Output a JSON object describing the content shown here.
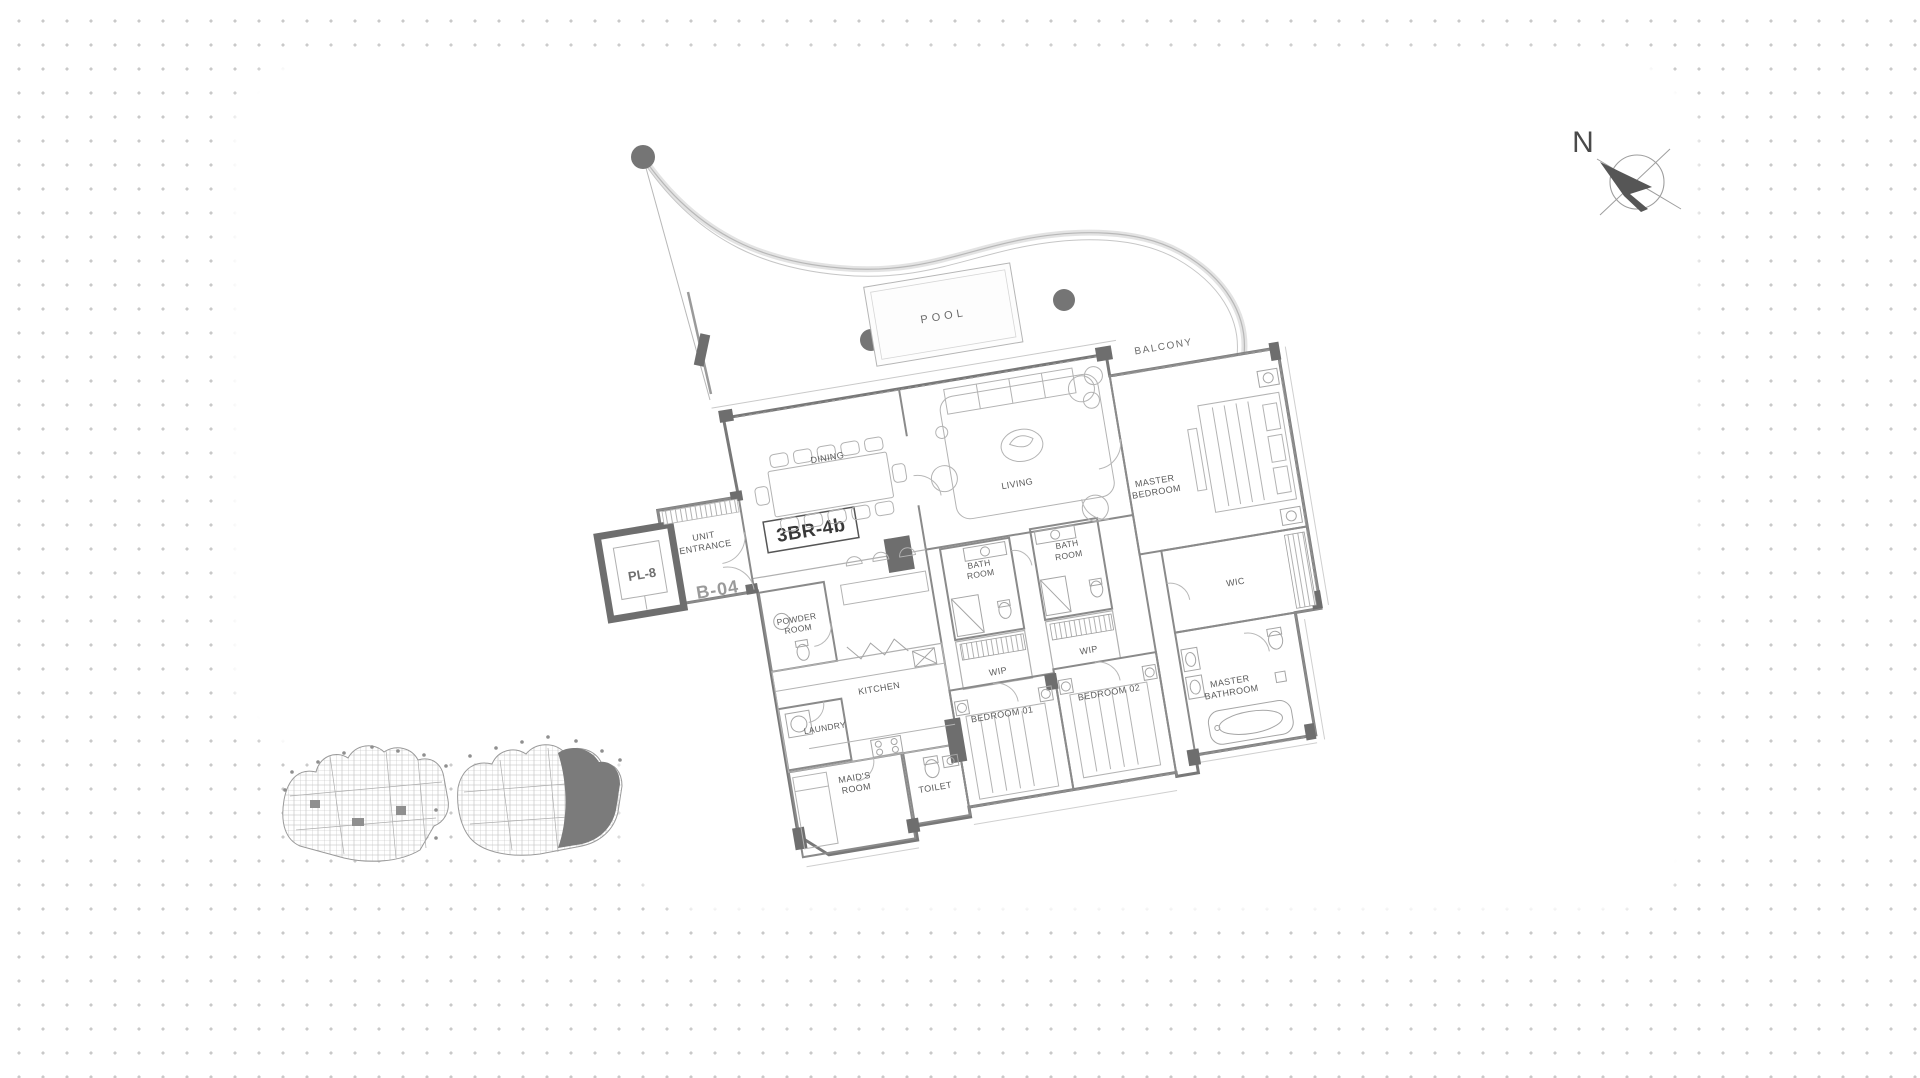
{
  "compass": {
    "north_label": "N"
  },
  "floor_plan": {
    "unit_label": "3BR-4b",
    "unit_number": "B-04",
    "elevator_label": "PL-8",
    "outdoor": {
      "pool": "POOL",
      "balcony": "BALCONY"
    },
    "rooms": {
      "dining": "DINING",
      "living": "LIVING",
      "master_bedroom_l1": "MASTER",
      "master_bedroom_l2": "BEDROOM",
      "wic": "WIC",
      "master_bathroom_l1": "MASTER",
      "master_bathroom_l2": "BATHROOM",
      "unit_entrance_l1": "UNIT",
      "unit_entrance_l2": "ENTRANCE",
      "powder_room_l1": "POWDER",
      "powder_room_l2": "ROOM",
      "bath_room_1_l1": "BATH",
      "bath_room_1_l2": "ROOM",
      "bath_room_2_l1": "BATH",
      "bath_room_2_l2": "ROOM",
      "wip_1": "WIP",
      "wip_2": "WIP",
      "kitchen": "KITCHEN",
      "laundry": "LAUNDRY",
      "maids_room_l1": "MAID'S",
      "maids_room_l2": "ROOM",
      "toilet": "TOILET",
      "bedroom_01": "BEDROOM 01",
      "bedroom_02": "BEDROOM 02"
    }
  }
}
